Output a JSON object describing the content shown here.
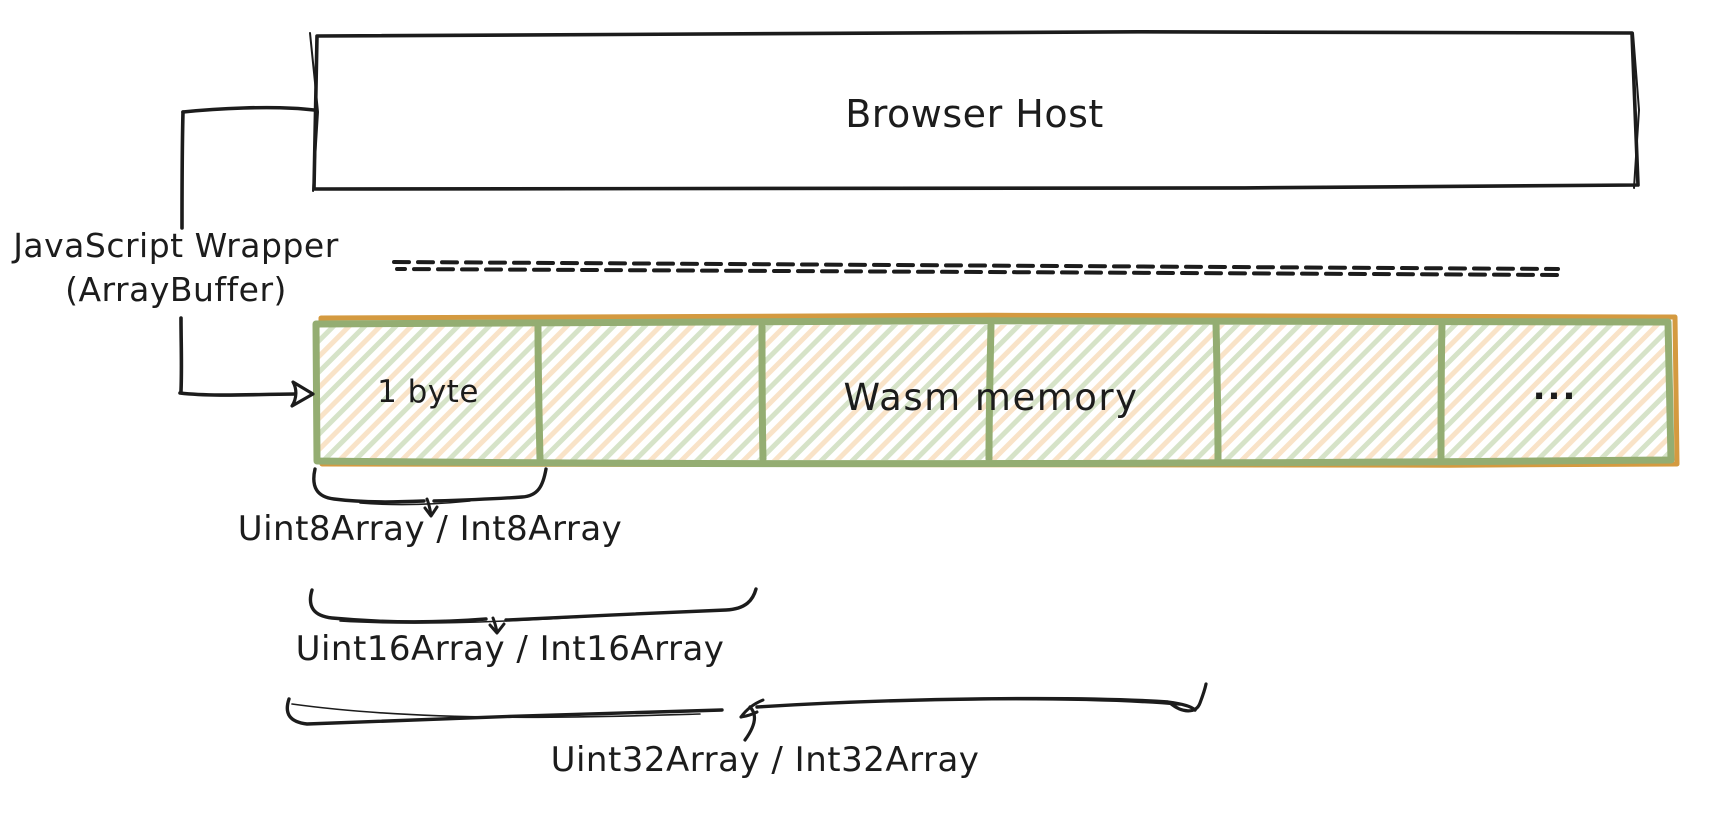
{
  "host": {
    "title": "Browser Host"
  },
  "wrapper": {
    "line1": "JavaScript Wrapper",
    "line2": "(ArrayBuffer)"
  },
  "memory_bar": {
    "first_cell_label": "1 byte",
    "overlay_label": "Wasm memory",
    "last_cell_label": "...",
    "cell_count": "6"
  },
  "typed_array_labels": {
    "int8": "Uint8Array / Int8Array",
    "int16": "Uint16Array / Int16Array",
    "int32": "Uint32Array / Int32Array"
  },
  "colors": {
    "ink": "#1c1c1c",
    "border_green": "#94ad72",
    "border_orange": "#d49a40",
    "hatch_green": "#d6e3c8",
    "hatch_peach": "#f9e3c8"
  }
}
